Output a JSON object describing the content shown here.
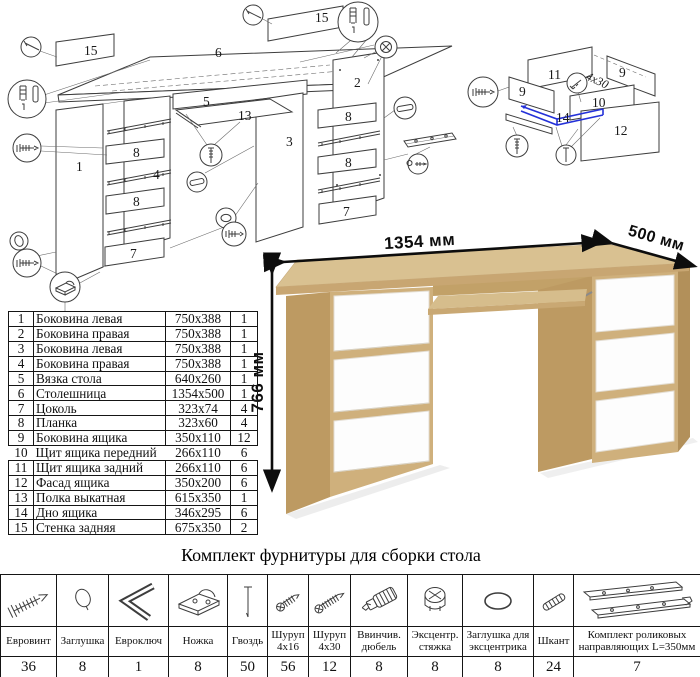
{
  "title": "Комплект фурнитуры для сборки стола",
  "desk": {
    "dim_width": "1354 мм",
    "dim_depth": "500 мм",
    "dim_height": "766 мм"
  },
  "parts_table": {
    "rows": [
      {
        "num": "1",
        "name": "Боковина левая",
        "size": "750x388",
        "qty": "1"
      },
      {
        "num": "2",
        "name": "Боковина правая",
        "size": "750x388",
        "qty": "1"
      },
      {
        "num": "3",
        "name": "Боковина левая",
        "size": "750x388",
        "qty": "1"
      },
      {
        "num": "4",
        "name": "Боковина правая",
        "size": "750x388",
        "qty": "1"
      },
      {
        "num": "5",
        "name": "Вязка стола",
        "size": "640x260",
        "qty": "1"
      },
      {
        "num": "6",
        "name": "Столешница",
        "size": "1354x500",
        "qty": "1"
      },
      {
        "num": "7",
        "name": "Цоколь",
        "size": "323x74",
        "qty": "4"
      },
      {
        "num": "8",
        "name": "Планка",
        "size": "323x60",
        "qty": "4"
      },
      {
        "num": "9",
        "name": "Боковина ящика",
        "size": "350x110",
        "qty": "12"
      },
      {
        "num": "10",
        "name": "Щит ящика передний",
        "size": "266x110",
        "qty": "6"
      },
      {
        "num": "11",
        "name": "Щит ящика задний",
        "size": "266x110",
        "qty": "6"
      },
      {
        "num": "12",
        "name": "Фасад ящика",
        "size": "350x200",
        "qty": "6"
      },
      {
        "num": "13",
        "name": "Полка выкатная",
        "size": "615x350",
        "qty": "1"
      },
      {
        "num": "14",
        "name": "Дно ящика",
        "size": "346x295",
        "qty": "6"
      },
      {
        "num": "15",
        "name": "Стенка задняя",
        "size": "675x350",
        "qty": "2"
      }
    ]
  },
  "hardware_table": {
    "items": [
      {
        "icon": "confirmat-screw",
        "name": "Евровинт",
        "qty": "36"
      },
      {
        "icon": "cap",
        "name": "Заглушка",
        "qty": "8"
      },
      {
        "icon": "hex-key",
        "name": "Евроключ",
        "qty": "1"
      },
      {
        "icon": "foot",
        "name": "Ножка",
        "qty": "8"
      },
      {
        "icon": "nail",
        "name": "Гвоздь",
        "qty": "50"
      },
      {
        "icon": "screw-small",
        "name": "Шуруп 4х16",
        "qty": "56"
      },
      {
        "icon": "screw-long",
        "name": "Шуруп 4х30",
        "qty": "12"
      },
      {
        "icon": "screw-dowel",
        "name": "Ввинчив. дюбель",
        "qty": "8"
      },
      {
        "icon": "cam-lock",
        "name": "Эксцентр. стяжка",
        "qty": "8"
      },
      {
        "icon": "cam-cap",
        "name": "Заглушка для эксцентрика",
        "qty": "8"
      },
      {
        "icon": "wood-dowel",
        "name": "Шкант",
        "qty": "24"
      },
      {
        "icon": "drawer-slides",
        "name": "Комплект роликовых направляющих L=350мм",
        "qty": "7"
      }
    ]
  },
  "main_diagram": {
    "labels": {
      "wall_left": "15",
      "wall_right": "15",
      "top": "6",
      "tie": "5",
      "shelf": "13",
      "p1": "1",
      "p2": "2",
      "p3": "3",
      "p4": "4",
      "plank_l1": "8",
      "plank_l2": "8",
      "base_l": "7",
      "plank_r1": "8",
      "plank_r2": "8",
      "base_r": "7"
    }
  },
  "drawer_diagram": {
    "labels": {
      "back": "11",
      "side_l": "9",
      "side_r": "9",
      "front": "10",
      "bottom": "14",
      "facade": "12"
    },
    "note": "4х30"
  }
}
